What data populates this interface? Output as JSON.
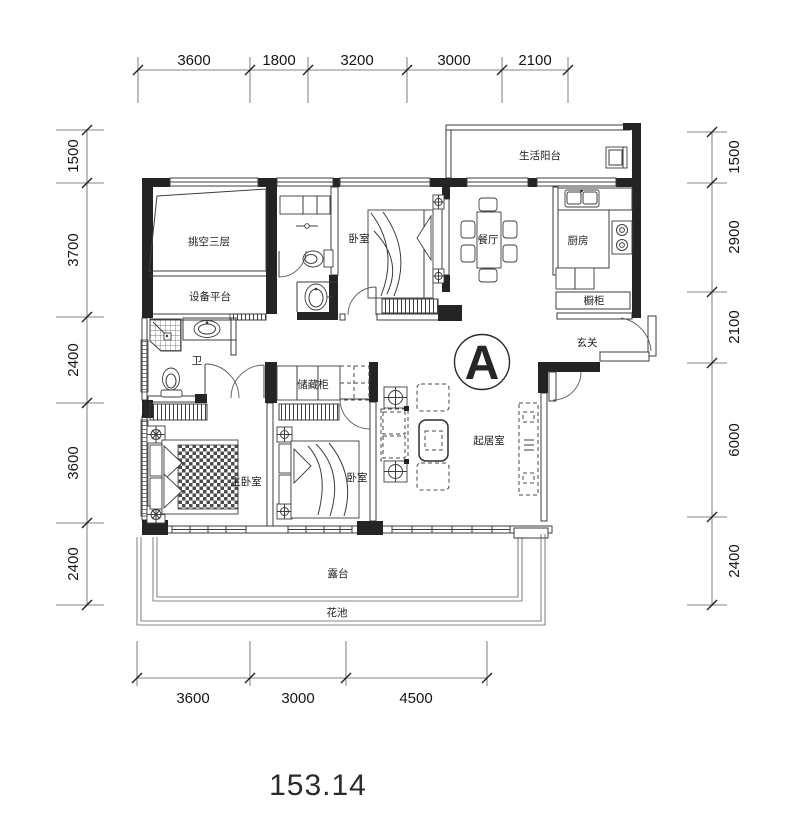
{
  "plan": {
    "unit_mark": "A",
    "total_area": "153.14",
    "rooms": {
      "living_balcony": "生活阳台",
      "void_three_storeys": "挑空三层",
      "equipment_platform": "设备平台",
      "bedroom_top": "卧室",
      "dining_room": "餐厅",
      "kitchen": "厨房",
      "kitchen_cabinet": "橱柜",
      "entry_hall": "玄关",
      "bathroom": "卫",
      "storage_cabinet": "储藏柜",
      "master_bedroom": "主卧室",
      "bedroom_bottom": "卧室",
      "living_room": "起居室",
      "terrace": "露台",
      "flower_bed": "花池"
    },
    "dimensions": {
      "top": [
        "3600",
        "1800",
        "3200",
        "3000",
        "2100"
      ],
      "left": [
        "1500",
        "3700",
        "2400",
        "3600",
        "2400"
      ],
      "right": [
        "1500",
        "2900",
        "2100",
        "6000",
        "2400"
      ],
      "bottom": [
        "3600",
        "3000",
        "4500"
      ]
    },
    "colors": {
      "wall_dark": "#242424",
      "line": "#3d3d3d",
      "dim_line": "#5c5c5c",
      "text": "#1d1d1d"
    }
  }
}
